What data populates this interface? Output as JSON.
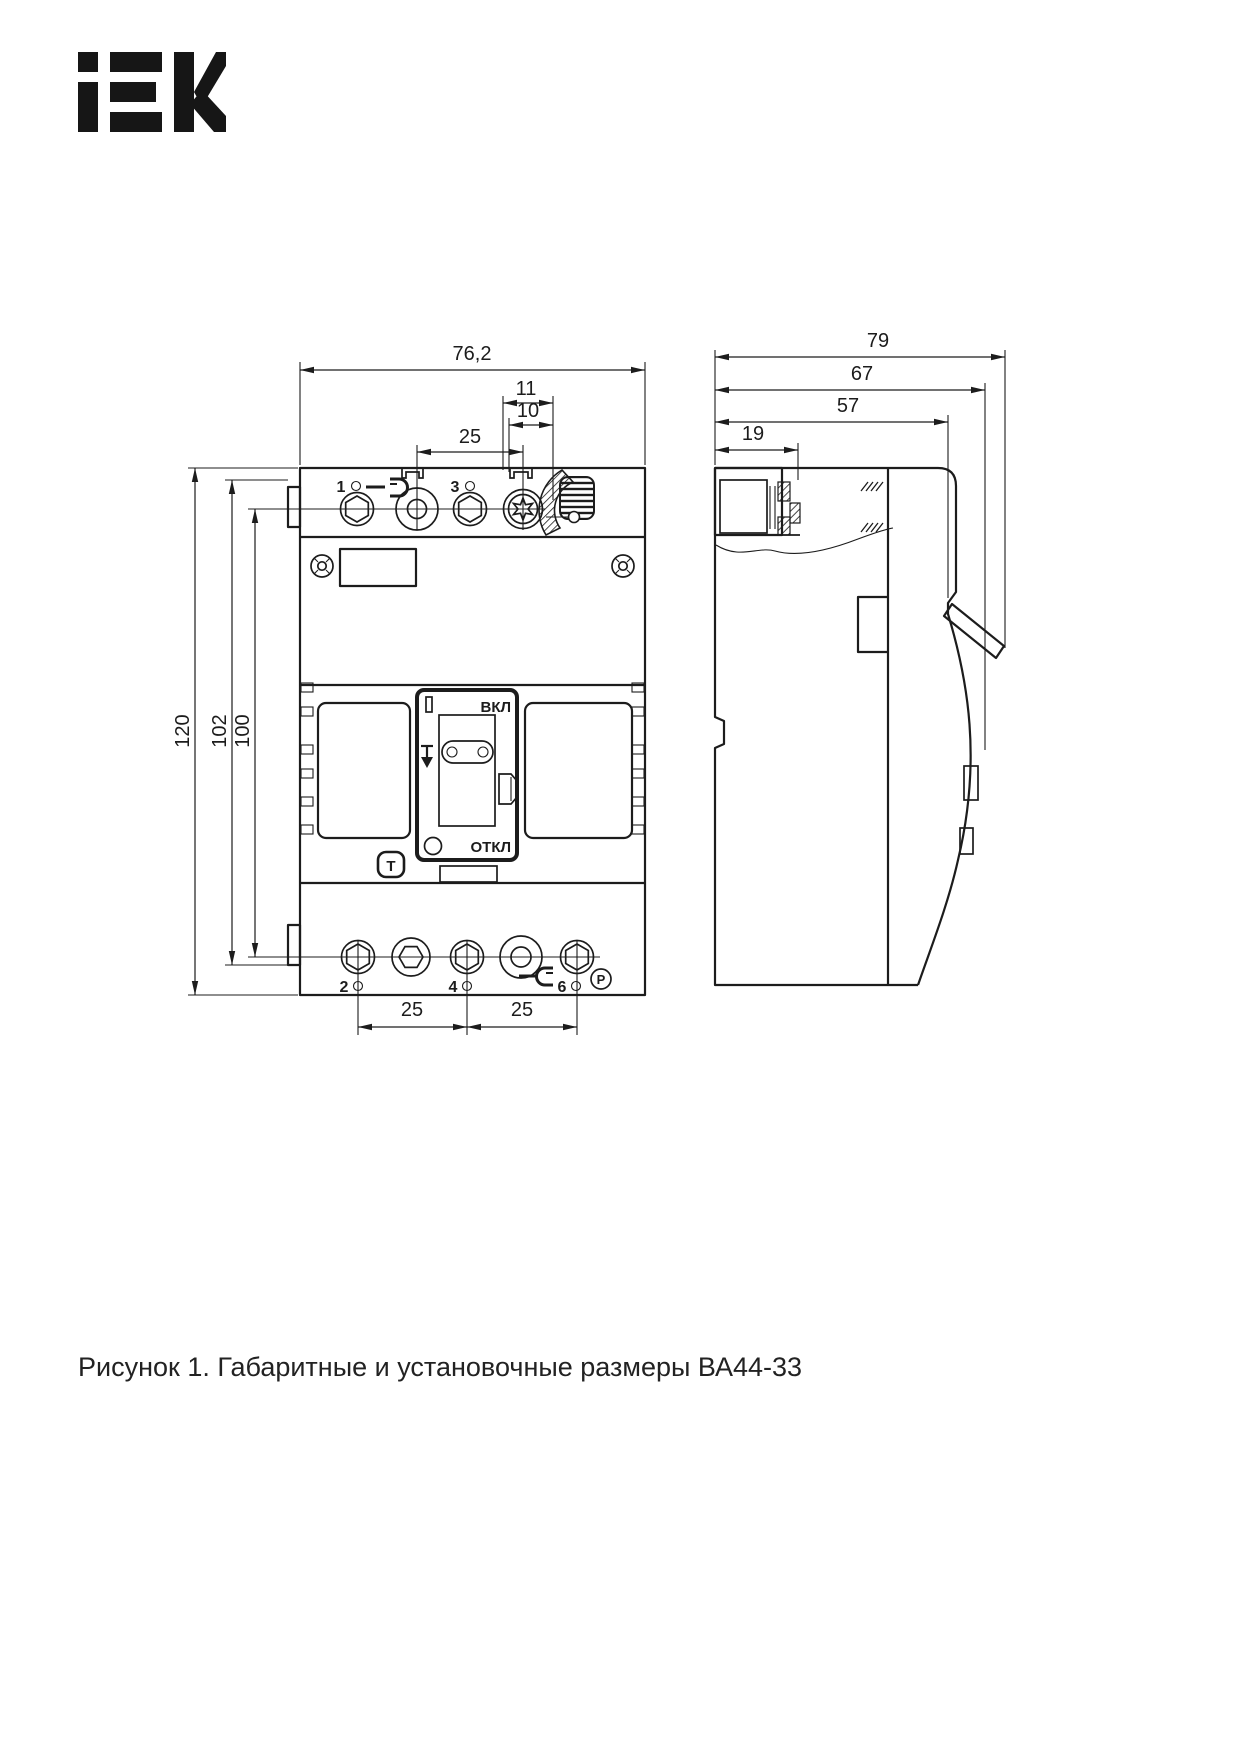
{
  "page": {
    "background": "#ffffff",
    "caption": "Рисунок 1. Габаритные и установочные размеры ВА44-33"
  },
  "logo": {
    "brand": "IEK",
    "display": "iEK",
    "color": "#161616"
  },
  "drawing": {
    "line_color": "#1c1c1c",
    "front_view": {
      "dim_width": "76,2",
      "dim_dial_outer": "11",
      "dim_dial_inner": "10",
      "dim_pitch_top": "25",
      "dim_height_overall": "120",
      "dim_mount_a": "102",
      "dim_mount_b": "100",
      "dim_pitch_bottom_1": "25",
      "dim_pitch_bottom_2": "25",
      "terminal_1": "1",
      "terminal_3": "3",
      "terminal_2": "2",
      "terminal_4": "4",
      "terminal_6": "6",
      "marking_on": "ВКЛ",
      "marking_off": "ОТКЛ",
      "marking_i": "I",
      "marking_test": "T",
      "marking_p": "P"
    },
    "side_view": {
      "dim_depth_overall": "79",
      "dim_depth_body": "67",
      "dim_depth_front": "57",
      "dim_terminal": "19"
    }
  }
}
